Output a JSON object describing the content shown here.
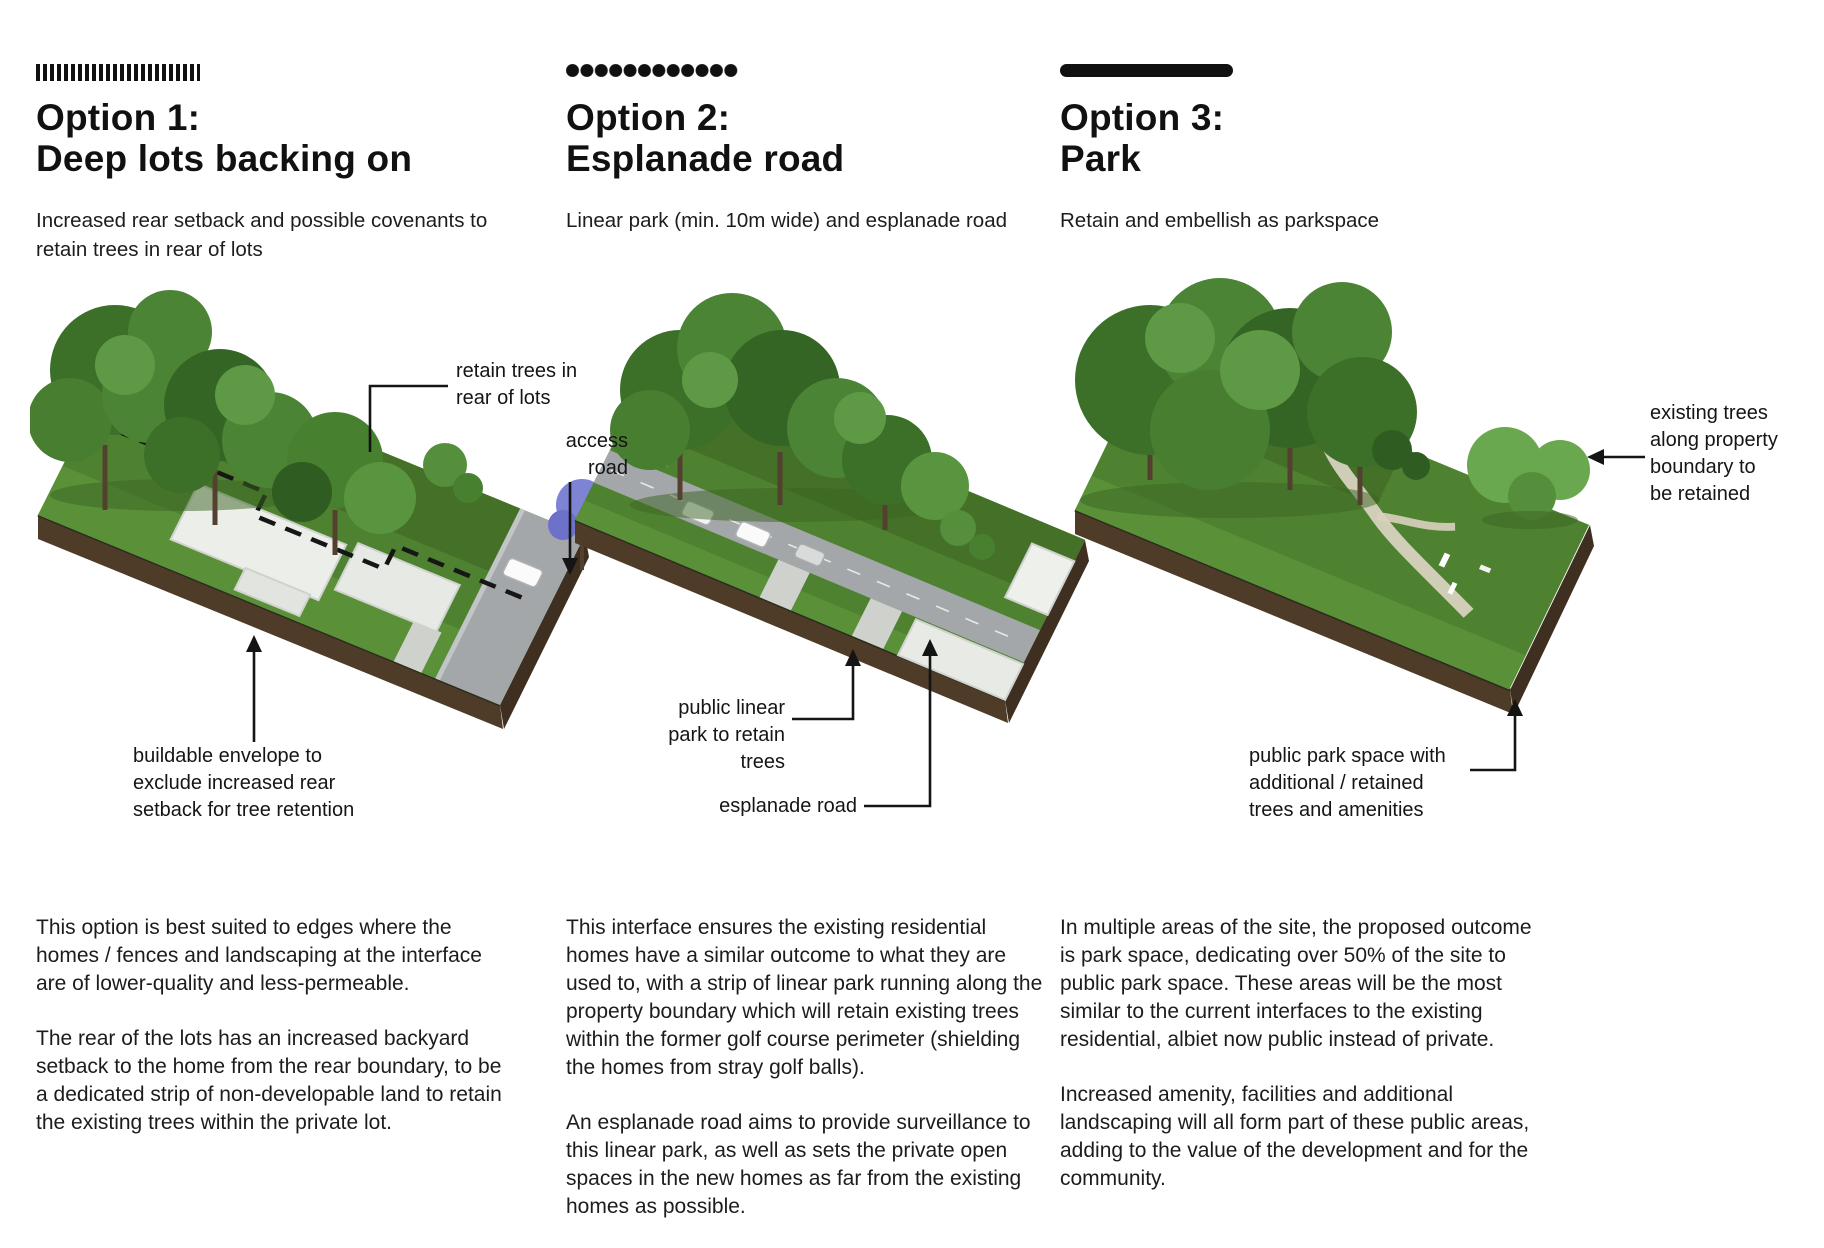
{
  "columns": [
    {
      "id": "option-1",
      "title": "Option 1:\nDeep lots backing on",
      "subtitle": "Increased rear setback and possible covenants to retain trees in rear of lots",
      "annotations": {
        "retain_trees": "retain trees in\nrear of lots",
        "access_road": "access\nroad",
        "buildable_envelope": "buildable envelope to\nexclude increased rear\nsetback for tree retention"
      },
      "paragraphs": [
        "This option is best suited to edges where the homes / fences and landscaping at the interface are of lower-quality and less-permeable.",
        "The rear of the lots has an increased backyard setback to the home from the rear boundary, to be a dedicated strip of non-developable land to retain the existing trees within the private lot."
      ]
    },
    {
      "id": "option-2",
      "title": "Option 2:\nEsplanade road",
      "subtitle": "Linear park (min. 10m wide) and esplanade road",
      "annotations": {
        "public_linear_park": "public linear\npark to retain\ntrees",
        "esplanade_road": "esplanade road"
      },
      "paragraphs": [
        "This interface ensures the existing residential homes have a similar outcome to what they are used to, with a strip of linear park running along the property boundary which will retain existing trees within the former golf course perimeter (shielding the homes from stray golf balls).",
        "An esplanade road aims to provide surveillance to this linear park, as well as sets the private open spaces in the new homes as far from the existing homes as possible."
      ]
    },
    {
      "id": "option-3",
      "title": "Option 3:\nPark",
      "subtitle": "Retain and embellish as parkspace",
      "annotations": {
        "existing_trees": "existing trees\nalong property\nboundary to\nbe retained",
        "public_park_space": "public park space with\nadditional / retained\ntrees and amenities"
      },
      "paragraphs": [
        "In multiple areas of the site, the proposed outcome is park space, dedicating over 50% of the site to public park space. These areas will be the most similar to the current interfaces to the existing residential, albiet now public instead of private.",
        "Increased amenity, facilities and additional landscaping will all form part of these public areas, adding to the value of the development and for the community."
      ]
    }
  ],
  "colors": {
    "ink": "#141414",
    "grass": "#4f8230",
    "grass_light": "#5a9038",
    "grass_dark": "#447027",
    "soil": "#4e3b28",
    "road": "#a3a7a9",
    "building": "#eceeea",
    "path": "#d8d2bf",
    "jacaranda": "#7f83d6"
  }
}
